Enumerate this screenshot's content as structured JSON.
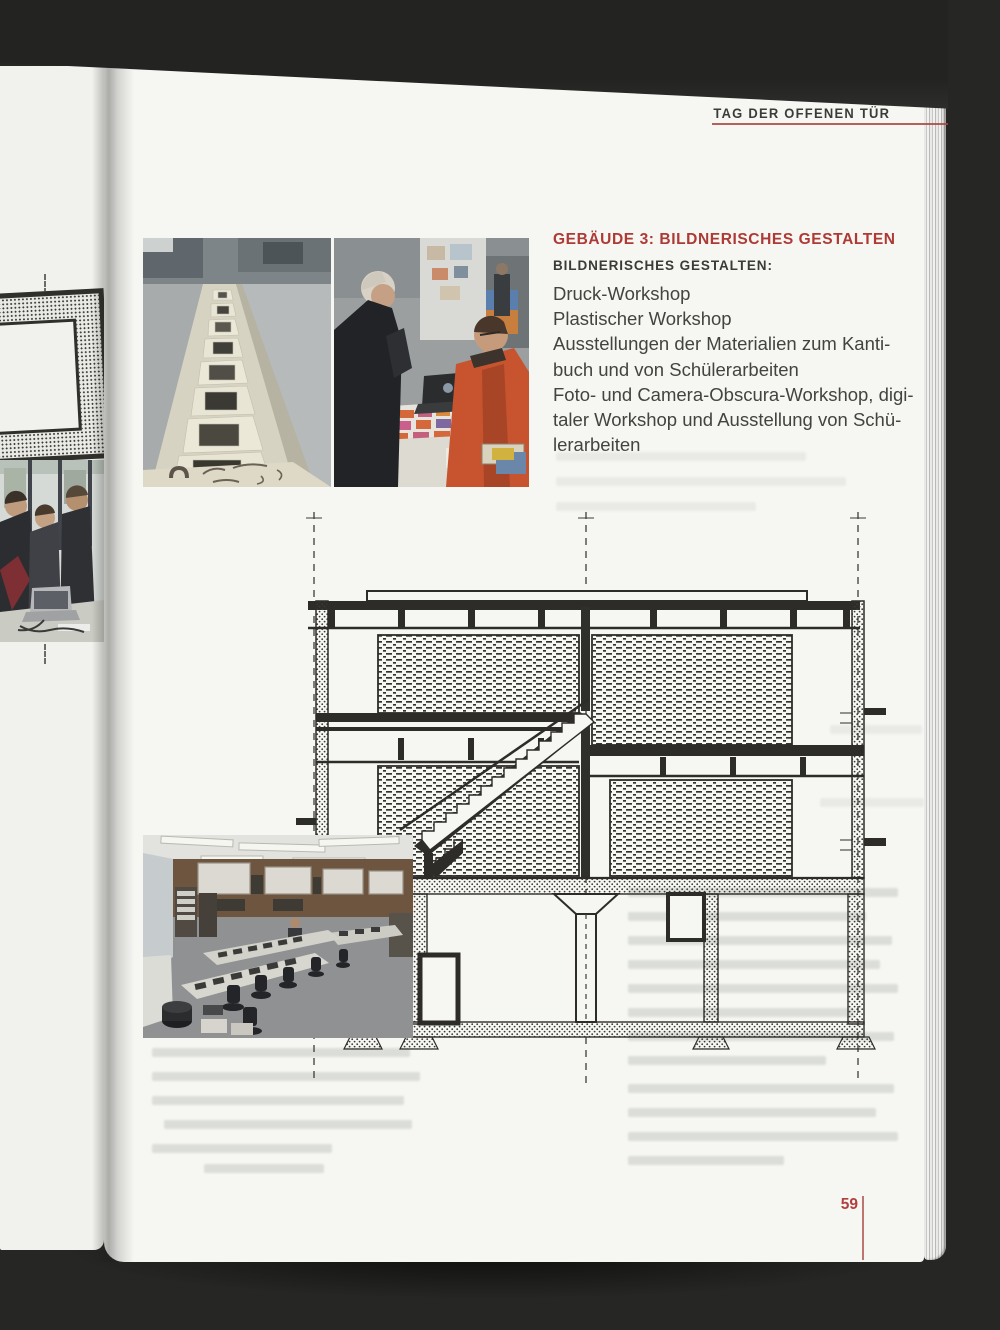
{
  "masthead": {
    "header": "TAG DER OFFENEN TÜR"
  },
  "article": {
    "heading": "GEBÄUDE 3: BILDNERISCHES GESTALTEN",
    "subheading": "BILDNERISCHES GESTALTEN:",
    "lines": [
      "Druck-Workshop",
      "Plastischer Workshop",
      "Ausstellungen der Materialien zum Kanti-",
      "buch und von Schülerarbeiten",
      "Foto- und Camera-Obscura-Workshop, digi-",
      "taler Workshop und Ausstellung von Schü-",
      "lerarbeiten"
    ]
  },
  "footer": {
    "page_number": "59"
  },
  "images": {
    "photo_prints_table": "exhibition prints laid out on a long table",
    "photo_visitors": "two visitors talking at an info table with flyers",
    "photo_classroom": "art classroom with work tables and prints",
    "drawing_section": "architectural cross-section of building 3",
    "left_page_photo": "visitors around a laptop (opposite page)"
  },
  "colors": {
    "accent_red": "#ad3a35",
    "rule_red": "#a8463f",
    "ink": "#2e2c29",
    "text": "#3f3f3c",
    "paper": "#f6f6f3",
    "background": "#262624"
  }
}
